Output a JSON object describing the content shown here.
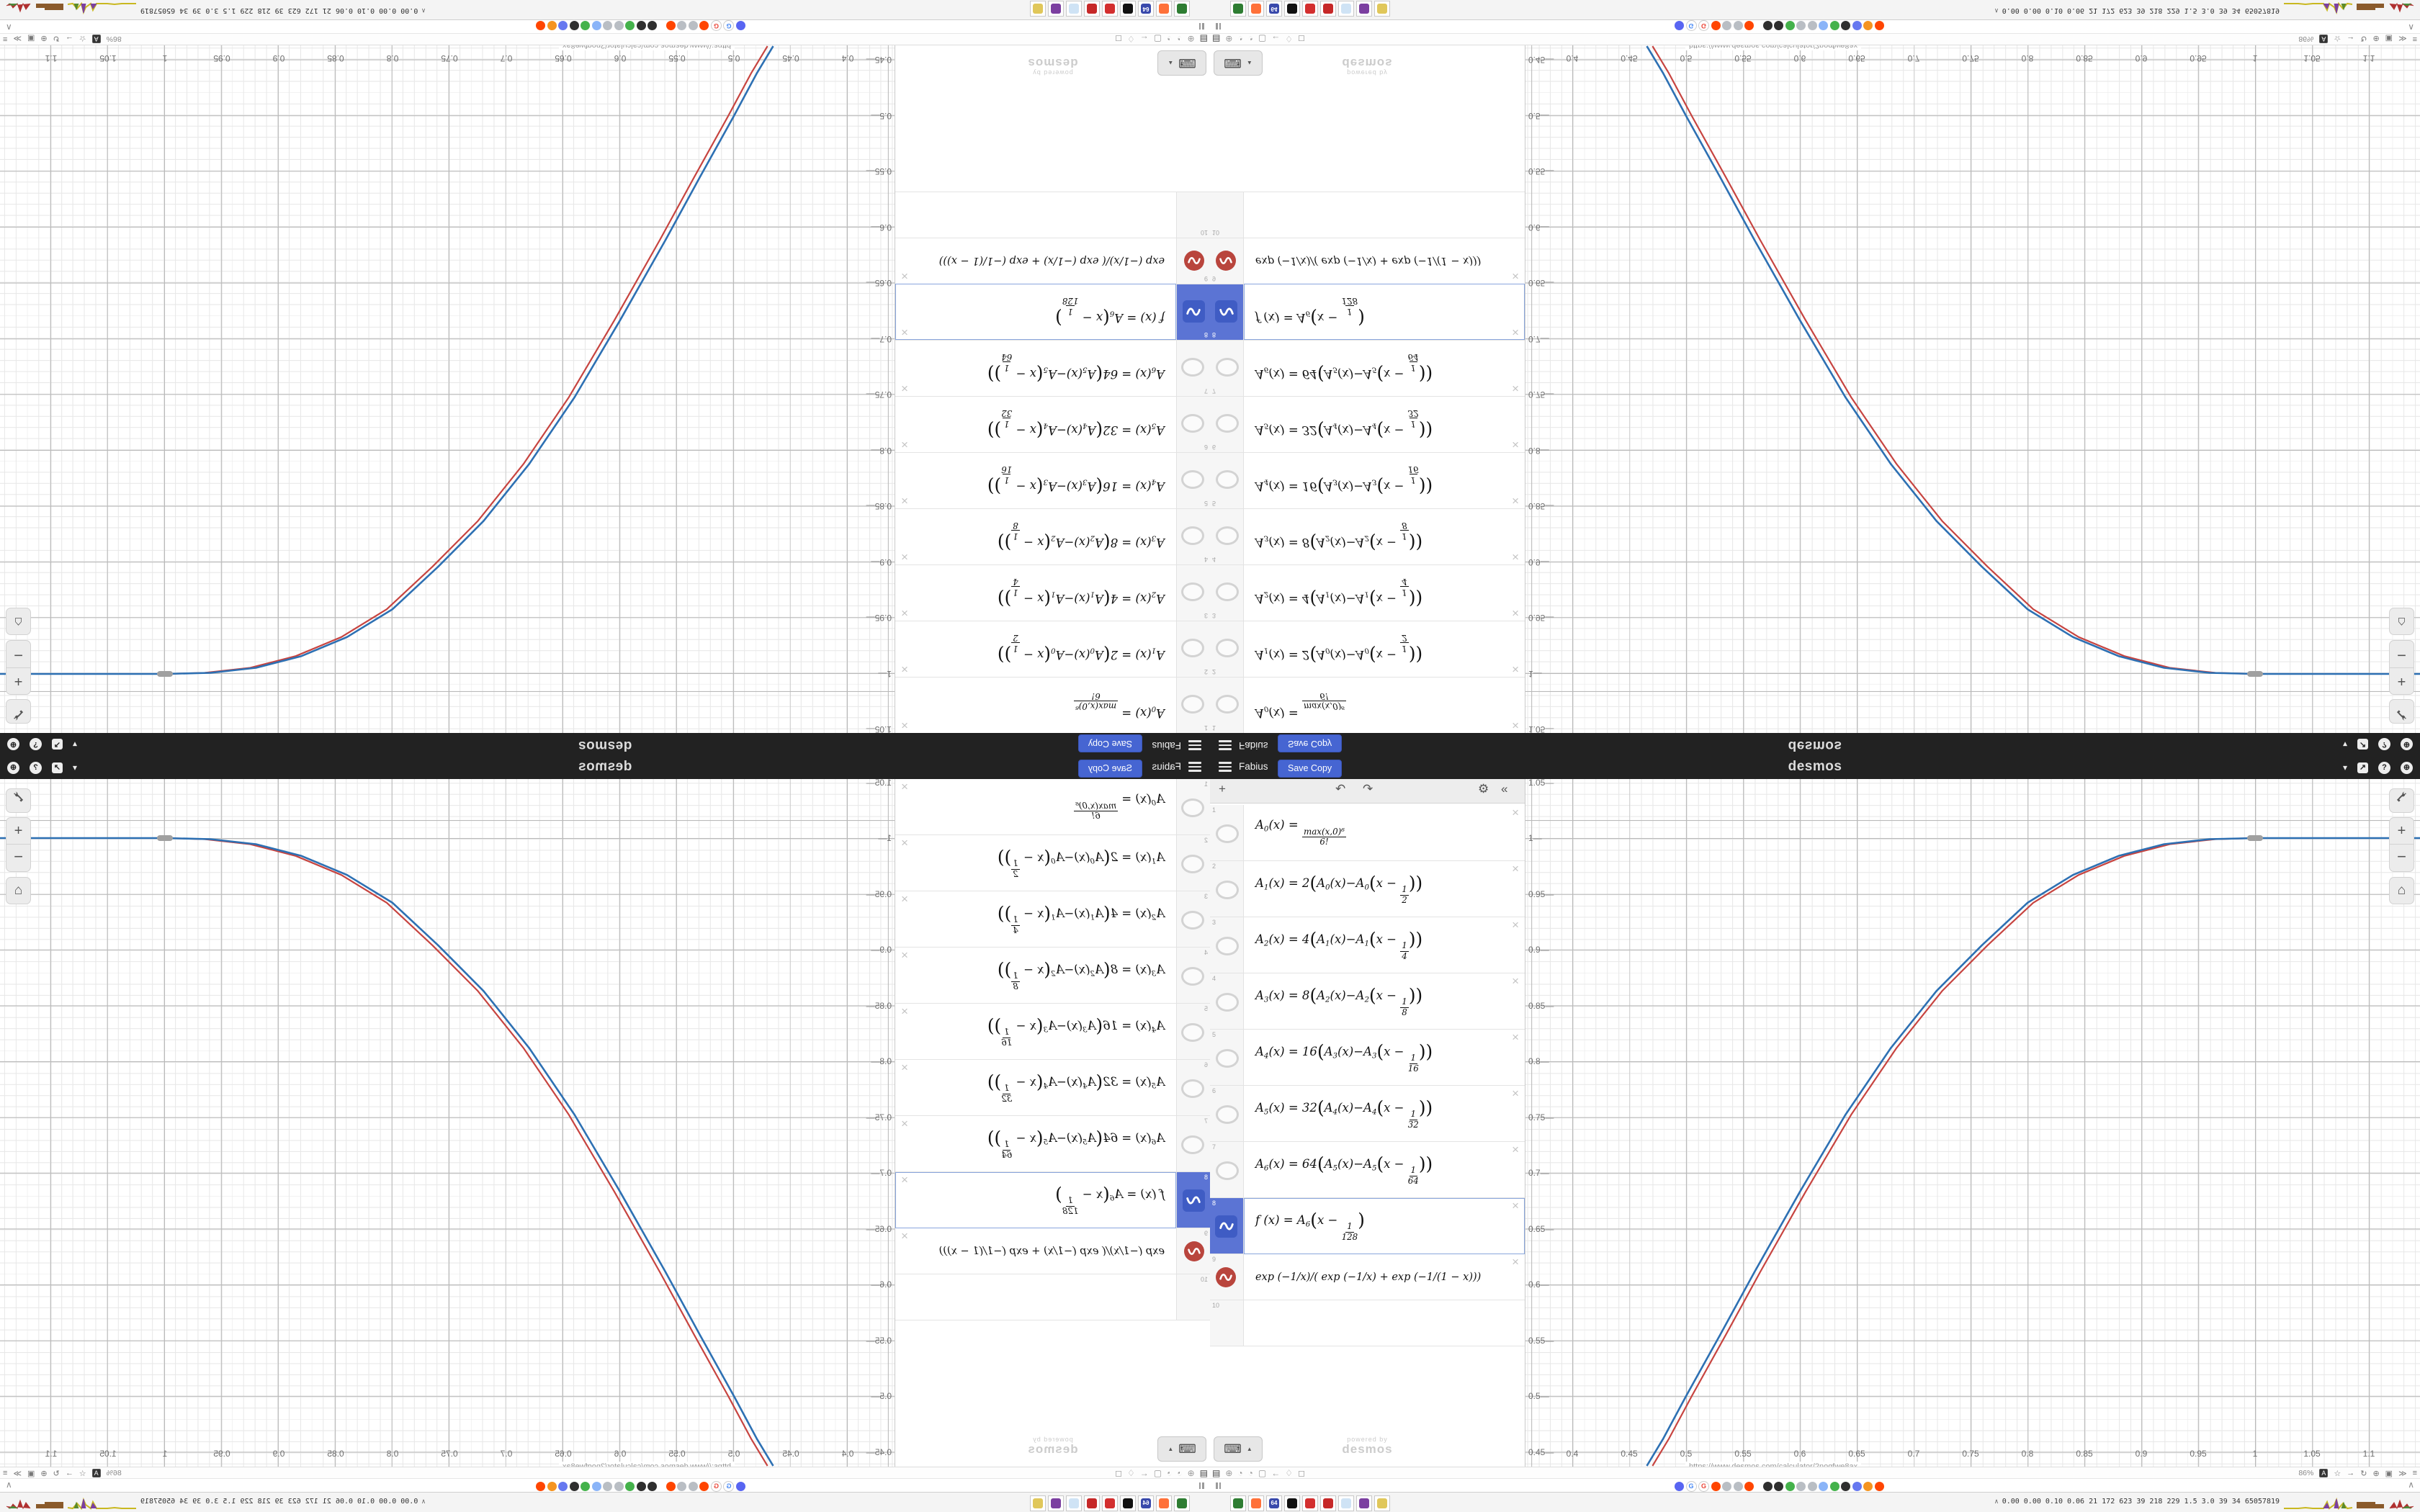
{
  "app": {
    "header": {
      "title": "Fabius",
      "save_label": "Save Copy",
      "logo": "desmos",
      "chevron": "▾",
      "share_glyph": "↗",
      "help_glyph": "?",
      "globe_glyph": "⊕",
      "accent_color": "#4665d2"
    },
    "toolbar": {
      "add": "+",
      "undo": "↶",
      "redo": "↷",
      "settings": "⚙",
      "collapse": "«"
    },
    "rows": [
      {
        "num": "1",
        "icon": "hidden-ellipse",
        "tokens": [
          [
            "t",
            "A"
          ],
          [
            "s",
            "0"
          ],
          [
            "t",
            "(x) = "
          ],
          [
            "F",
            "max(x,0)⁶",
            "6!"
          ]
        ]
      },
      {
        "num": "2",
        "icon": "hidden-ellipse",
        "tokens": [
          [
            "t",
            "A"
          ],
          [
            "s",
            "1"
          ],
          [
            "t",
            "(x) = 2"
          ],
          [
            "b",
            "("
          ],
          [
            "t",
            "A"
          ],
          [
            "s",
            "0"
          ],
          [
            "t",
            "(x)−A"
          ],
          [
            "s",
            "0"
          ],
          [
            "b",
            "("
          ],
          [
            "t",
            "x − "
          ],
          [
            "F",
            "1",
            "2"
          ],
          [
            "b",
            ")"
          ],
          [
            "b",
            ")"
          ]
        ]
      },
      {
        "num": "3",
        "icon": "hidden-ellipse",
        "tokens": [
          [
            "t",
            "A"
          ],
          [
            "s",
            "2"
          ],
          [
            "t",
            "(x) = 4"
          ],
          [
            "b",
            "("
          ],
          [
            "t",
            "A"
          ],
          [
            "s",
            "1"
          ],
          [
            "t",
            "(x)−A"
          ],
          [
            "s",
            "1"
          ],
          [
            "b",
            "("
          ],
          [
            "t",
            "x − "
          ],
          [
            "F",
            "1",
            "4"
          ],
          [
            "b",
            ")"
          ],
          [
            "b",
            ")"
          ]
        ]
      },
      {
        "num": "4",
        "icon": "hidden-ellipse",
        "tokens": [
          [
            "t",
            "A"
          ],
          [
            "s",
            "3"
          ],
          [
            "t",
            "(x) = 8"
          ],
          [
            "b",
            "("
          ],
          [
            "t",
            "A"
          ],
          [
            "s",
            "2"
          ],
          [
            "t",
            "(x)−A"
          ],
          [
            "s",
            "2"
          ],
          [
            "b",
            "("
          ],
          [
            "t",
            "x − "
          ],
          [
            "F",
            "1",
            "8"
          ],
          [
            "b",
            ")"
          ],
          [
            "b",
            ")"
          ]
        ]
      },
      {
        "num": "5",
        "icon": "hidden-ellipse",
        "tokens": [
          [
            "t",
            "A"
          ],
          [
            "s",
            "4"
          ],
          [
            "t",
            "(x) = 16"
          ],
          [
            "b",
            "("
          ],
          [
            "t",
            "A"
          ],
          [
            "s",
            "3"
          ],
          [
            "t",
            "(x)−A"
          ],
          [
            "s",
            "3"
          ],
          [
            "b",
            "("
          ],
          [
            "t",
            "x − "
          ],
          [
            "F",
            "1",
            "16"
          ],
          [
            "b",
            ")"
          ],
          [
            "b",
            ")"
          ]
        ]
      },
      {
        "num": "6",
        "icon": "hidden-ellipse",
        "tokens": [
          [
            "t",
            "A"
          ],
          [
            "s",
            "5"
          ],
          [
            "t",
            "(x) = 32"
          ],
          [
            "b",
            "("
          ],
          [
            "t",
            "A"
          ],
          [
            "s",
            "4"
          ],
          [
            "t",
            "(x)−A"
          ],
          [
            "s",
            "4"
          ],
          [
            "b",
            "("
          ],
          [
            "t",
            "x − "
          ],
          [
            "F",
            "1",
            "32"
          ],
          [
            "b",
            ")"
          ],
          [
            "b",
            ")"
          ]
        ]
      },
      {
        "num": "7",
        "icon": "hidden-ellipse",
        "tokens": [
          [
            "t",
            "A"
          ],
          [
            "s",
            "6"
          ],
          [
            "t",
            "(x) = 64"
          ],
          [
            "b",
            "("
          ],
          [
            "t",
            "A"
          ],
          [
            "s",
            "5"
          ],
          [
            "t",
            "(x)−A"
          ],
          [
            "s",
            "5"
          ],
          [
            "b",
            "("
          ],
          [
            "t",
            "x − "
          ],
          [
            "F",
            "1",
            "64"
          ],
          [
            "b",
            ")"
          ],
          [
            "b",
            ")"
          ]
        ]
      },
      {
        "num": "8",
        "icon": "blue-wave-tile",
        "selected": true,
        "tokens": [
          [
            "t",
            "f (x) = A"
          ],
          [
            "s",
            "6"
          ],
          [
            "b",
            "("
          ],
          [
            "t",
            "x − "
          ],
          [
            "F",
            "1",
            "128"
          ],
          [
            "b",
            ")"
          ]
        ]
      },
      {
        "num": "9",
        "icon": "red-wave-circle",
        "small": true,
        "tokens": [
          [
            "t",
            "exp (−1/x)/( exp (−1/x) + exp (−1/(1 − x)))"
          ]
        ]
      },
      {
        "num": "10",
        "icon": "none",
        "tokens": []
      }
    ],
    "keyboard_button": {
      "icon": "⌨",
      "arrow": "▲"
    },
    "watermark": {
      "line1": "powered by",
      "line2": "desmos"
    },
    "graph_controls": {
      "wrench": "wrench-icon",
      "zoom_in": "+",
      "zoom_out": "−",
      "home": "⌂"
    },
    "link_preview": "https://www.desmos.com/calculator/2nogfwe8ax",
    "status_bar": {
      "left_icons": [
        "▤",
        "⊕",
        "◔",
        "◔",
        "▢",
        "←",
        "♢",
        "◻"
      ],
      "zoom_level": "86%",
      "right_icons": [
        "A",
        "☆",
        "→",
        "↻",
        "⊕",
        "▣",
        "≫",
        "≡"
      ]
    },
    "tab_bar": {
      "collapse": "∧",
      "favicons": [
        {
          "c": "#5865f2",
          "g": ""
        },
        {
          "c": "#ffffff",
          "g": "G",
          "gc": "#4285f4"
        },
        {
          "c": "#ffffff",
          "g": "G",
          "gc": "#ea4335"
        },
        {
          "c": "#ff4500",
          "g": ""
        },
        {
          "c": "#b9bec4",
          "g": ""
        },
        {
          "c": "#b9bec4",
          "g": ""
        },
        {
          "c": "#ff4500",
          "g": ""
        },
        {
          "c": "#2f2f2f",
          "g": ""
        },
        {
          "c": "#2f2f2f",
          "g": ""
        },
        {
          "c": "#44b24b",
          "g": ""
        },
        {
          "c": "#b9bec4",
          "g": ""
        },
        {
          "c": "#b9bec4",
          "g": ""
        },
        {
          "c": "#8ab4f8",
          "g": ""
        },
        {
          "c": "#44b24b",
          "g": ""
        },
        {
          "c": "#2f2f2f",
          "g": ""
        },
        {
          "c": "#6678f0",
          "g": ""
        },
        {
          "c": "#f59420",
          "g": ""
        },
        {
          "c": "#ff4500",
          "g": ""
        }
      ]
    },
    "taskbar": {
      "caret": "∧",
      "stats": "0.00 0.00 0.10 0.06  21  172  623  39  218  229  1.5  3.0  39  34  65057819",
      "apps": [
        {
          "c": "#2e7d32"
        },
        {
          "c": "#ff7139"
        },
        {
          "c": "#3949ab",
          "g": "64"
        },
        {
          "c": "#111111"
        },
        {
          "c": "#d32f2f"
        },
        {
          "c": "#c62828"
        },
        {
          "c": "#cfe3f5"
        },
        {
          "c": "#7b3fa0"
        },
        {
          "c": "#e0c75a"
        }
      ]
    }
  },
  "chart_data": {
    "type": "line",
    "title": "",
    "xlabel": "",
    "ylabel": "",
    "xlim": [
      0.358,
      1.145
    ],
    "ylim": [
      0.4375,
      1.0535
    ],
    "x_ticks": [
      0.4,
      0.45,
      0.5,
      0.55,
      0.6,
      0.65,
      0.7,
      0.75,
      0.8,
      0.85,
      0.9,
      0.95,
      1,
      1.05,
      1.1
    ],
    "y_ticks": [
      1.05,
      1,
      0.95,
      0.9,
      0.85,
      0.8,
      0.75,
      0.7,
      0.65,
      0.6,
      0.55,
      0.5,
      0.45
    ],
    "grid": {
      "minor_step": 0.01,
      "major_step": 0.05,
      "on": true
    },
    "legend_position": "none",
    "series": [
      {
        "name": "exp(−1/x)/(exp(−1/x)+exp(−1/(1−x)))",
        "color": "#c74440",
        "width": 2.2,
        "points": [
          [
            0.4705,
            0.4375
          ],
          [
            0.485,
            0.462
          ],
          [
            0.505,
            0.5
          ],
          [
            0.535,
            0.555
          ],
          [
            0.565,
            0.611
          ],
          [
            0.605,
            0.683
          ],
          [
            0.645,
            0.752
          ],
          [
            0.685,
            0.812
          ],
          [
            0.725,
            0.863
          ],
          [
            0.765,
            0.904
          ],
          [
            0.805,
            0.942
          ],
          [
            0.845,
            0.967
          ],
          [
            0.885,
            0.984
          ],
          [
            0.925,
            0.9945
          ],
          [
            0.965,
            0.999
          ],
          [
            1.0,
            1.0
          ]
        ]
      },
      {
        "name": "f(x) = A₆(x − 1/128)",
        "color": "#2d70b3",
        "width": 2.6,
        "points": [
          [
            0.4655,
            0.4375
          ],
          [
            0.48,
            0.462
          ],
          [
            0.5,
            0.5
          ],
          [
            0.53,
            0.555
          ],
          [
            0.56,
            0.611
          ],
          [
            0.6,
            0.683
          ],
          [
            0.64,
            0.752
          ],
          [
            0.68,
            0.812
          ],
          [
            0.72,
            0.863
          ],
          [
            0.76,
            0.904
          ],
          [
            0.8,
            0.942
          ],
          [
            0.84,
            0.967
          ],
          [
            0.88,
            0.984
          ],
          [
            0.92,
            0.9945
          ],
          [
            0.96,
            0.999
          ],
          [
            1.0,
            1.0
          ],
          [
            1.145,
            1.0
          ]
        ]
      }
    ],
    "annotations": [
      {
        "type": "endpoint-pill",
        "x": 1.0,
        "y": 1.0,
        "color": "#a0a0a0"
      }
    ]
  }
}
